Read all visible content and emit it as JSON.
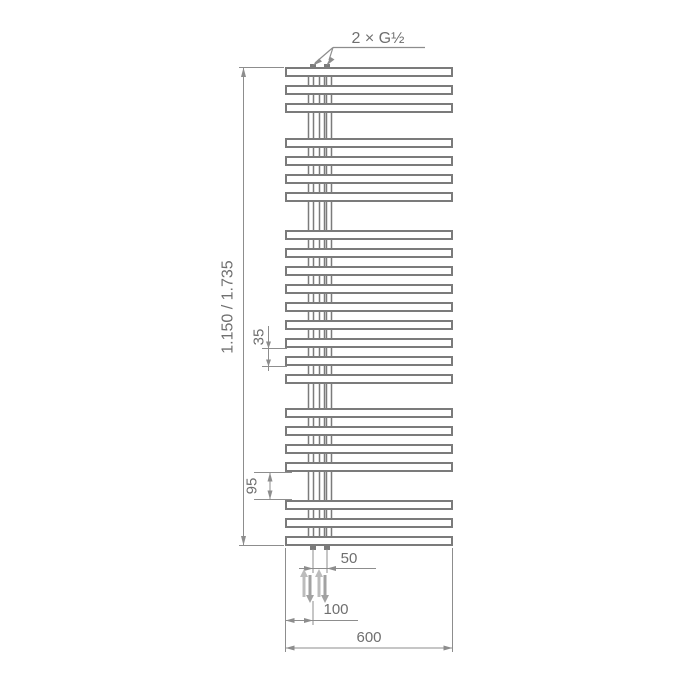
{
  "drawing": {
    "type": "towel-radiator technical dimension drawing",
    "dimensions": {
      "connections": "2 × G½",
      "height": "1.150 / 1.735",
      "tube_spacing": "35",
      "group_gap": "95",
      "connection_spacing": "50",
      "connection_offset": "100",
      "width": "600"
    },
    "radiator": {
      "tube_groups": [
        {
          "bars": 3
        },
        {
          "bars": 4
        },
        {
          "bars": 9
        },
        {
          "bars": 4
        },
        {
          "bars": 3
        }
      ]
    },
    "colors": {
      "outline": "#7b7b7b",
      "dimension_line": "#8d8d8d",
      "label_text": "#6f6f6f",
      "flow_arrow_up": "#bcbcbc",
      "flow_arrow_down": "#a2a2a2",
      "background": "#ffffff"
    }
  }
}
